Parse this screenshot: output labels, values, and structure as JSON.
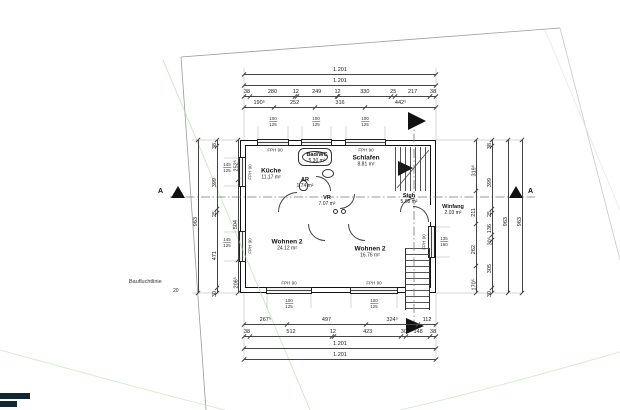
{
  "rooms": [
    {
      "name": "Küche",
      "area": "11.17 m²"
    },
    {
      "name": "Bad/WC",
      "area": "5.30 m²"
    },
    {
      "name": "Schlafen",
      "area": "8.81 m²"
    },
    {
      "name": "AR",
      "area": "1.74 m²"
    },
    {
      "name": "VR",
      "area": "7.07 m²"
    },
    {
      "name": "Stgh",
      "area": "5.08 m²"
    },
    {
      "name": "Winfang",
      "area": "2.03 m²"
    },
    {
      "name": "Wohnen 2",
      "area": "24.12 m²"
    },
    {
      "name": "Wohnen 2",
      "area": "16.76 m²"
    }
  ],
  "labels": {
    "window": "FPH 90",
    "section": "A",
    "boundary": "Baufluchtlinie",
    "small_dim": "20"
  },
  "window_specs": {
    "top1": "100/125",
    "top2": "100/125",
    "top3": "100/125",
    "left1": "145/125",
    "left2": "145/125",
    "bottom1": "100/125",
    "bottom2": "100/125",
    "right1": "135/160"
  },
  "dims": {
    "top1": [
      "1.201"
    ],
    "top2": [
      "1.201"
    ],
    "top3": [
      "38",
      "280",
      "12",
      "249",
      "12",
      "330",
      "25",
      "217",
      "38"
    ],
    "top4": [
      "190⁵",
      "252",
      "316",
      "442⁵"
    ],
    "bottom1": [
      "267⁵",
      "497",
      "324⁵",
      "112"
    ],
    "bottom2": [
      "38",
      "512",
      "12",
      "423",
      "30",
      "148",
      "38"
    ],
    "bottom3": [
      "1.201"
    ],
    "bottom4": [
      "1.201"
    ],
    "left_inner": [
      "252⁵",
      "504",
      "206⁵"
    ],
    "left_mid": [
      "38",
      "399",
      "25",
      "471",
      "30"
    ],
    "left_outer": [
      "963"
    ],
    "right_inner": [
      "319⁵",
      "211",
      "262",
      "170⁵"
    ],
    "right_mid": [
      "38",
      "399",
      "25",
      "136",
      "30⁵",
      "305",
      "30"
    ],
    "right_outer1": [
      "963"
    ],
    "right_outer2": [
      "963"
    ]
  }
}
